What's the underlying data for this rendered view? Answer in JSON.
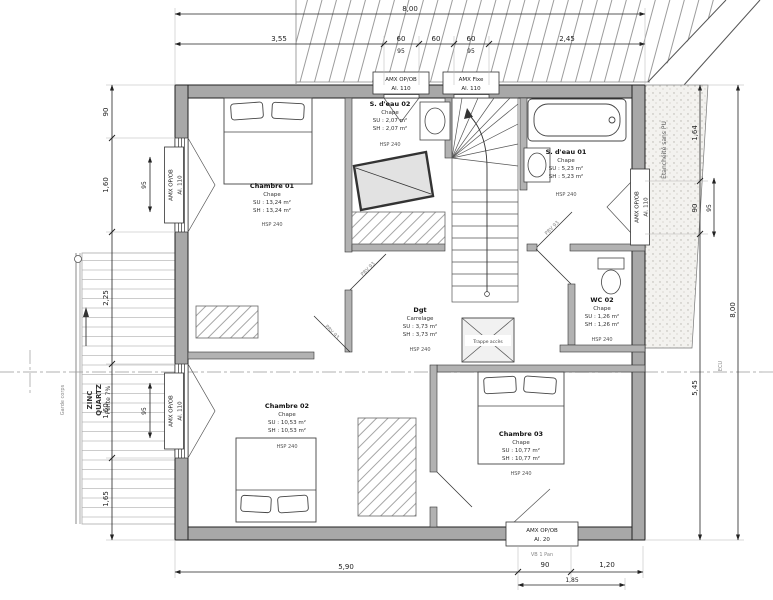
{
  "rooms": [
    {
      "name": "Chambre 01",
      "finish": "Chape",
      "su": "SU : 13,24 m²",
      "sh": "SH : 13,24 m²",
      "hsp": "HSP 240"
    },
    {
      "name": "S. d'eau 02",
      "finish": "Chape",
      "su": "SU : 2,07 m²",
      "sh": "SH : 2,07 m²",
      "hsp": "HSP 240"
    },
    {
      "name": "S. d'eau 01",
      "finish": "Chape",
      "su": "SU : 5,23 m²",
      "sh": "SH : 5,23 m²",
      "hsp": "HSP 240"
    },
    {
      "name": "WC 02",
      "finish": "Chape",
      "su": "SU : 1,26 m²",
      "sh": "SH : 1,26 m²",
      "hsp": "HSP 240"
    },
    {
      "name": "Dgt",
      "finish": "Carrelage",
      "su": "SU : 3,73 m²",
      "sh": "SH : 3,73 m²",
      "hsp": "HSP 240"
    },
    {
      "name": "Chambre 02",
      "finish": "Chape",
      "su": "SU : 10,53 m²",
      "sh": "SH : 10,53 m²",
      "hsp": "HSP 240"
    },
    {
      "name": "Chambre 03",
      "finish": "Chape",
      "su": "SU : 10,77 m²",
      "sh": "SH : 10,77 m²",
      "hsp": "HSP 240"
    }
  ],
  "window_labels": {
    "top_left": {
      "l1": "AMX OP/OB",
      "l2": "Al. 110"
    },
    "top_right": {
      "l1": "AMX Fixe",
      "l2": "Al. 110"
    },
    "left_upper": {
      "l1": "AMX OP/OB",
      "l2": "Al. 110"
    },
    "left_lower": {
      "l1": "AMX OP/OB",
      "l2": "Al. 110"
    },
    "right": {
      "l1": "AMX OP/OB",
      "l2": "Al. 110"
    },
    "bottom": {
      "l1": "AMX OP/OB",
      "l2": "Al. 20",
      "l3": "VB 1 Pan"
    }
  },
  "dims": {
    "top": {
      "overall": "8,00",
      "a": "3,55",
      "b": "60",
      "b2": "95",
      "c": "60",
      "d": "60",
      "d2": "95",
      "e": "2,45"
    },
    "bottom": {
      "a": "5,90",
      "b": "90",
      "b2": "1,85",
      "c": "1,20"
    },
    "left": {
      "a": "90",
      "b": "1,60",
      "b2": "95",
      "c": "2,25",
      "d": "1,60",
      "d2": "95",
      "e": "1,65"
    },
    "right": {
      "a": "1,64",
      "b": "90",
      "b2": "95",
      "c": "5,45",
      "overall": "8,00"
    }
  },
  "annotations": {
    "zinc_l1": "ZINC",
    "zinc_l2": "QUARTZ",
    "zinc_l3": "Pente 7%",
    "terrace": "Étanchéité sans PU",
    "guardrail": "Garde corps",
    "trappe": "Trappe accès",
    "door_tag": "PBV 93",
    "axis_tag": "ECU"
  }
}
